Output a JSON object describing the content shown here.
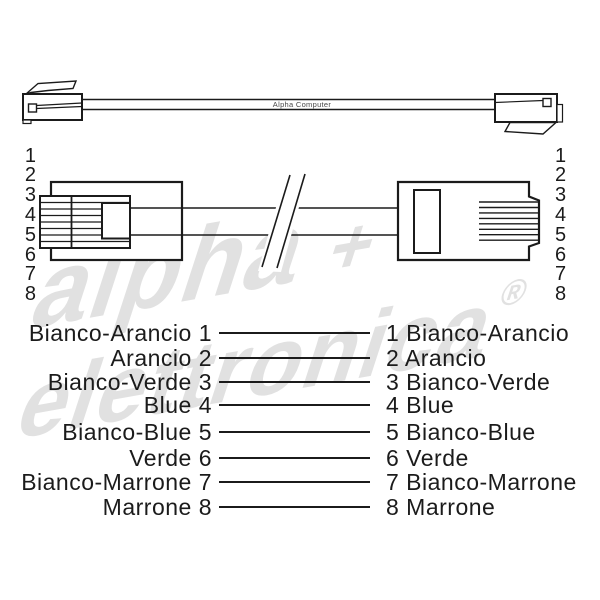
{
  "watermark": {
    "word1": "alpha",
    "plus": "+",
    "word2": "elettronica",
    "registered": "®",
    "color": "#e1e1e1"
  },
  "cable": {
    "brand_label": "Alpha Computer"
  },
  "pin_numbers": [
    "1",
    "2",
    "3",
    "4",
    "5",
    "6",
    "7",
    "8"
  ],
  "wiring_rows": [
    {
      "pin": "1",
      "color_name": "Bianco-Arancio",
      "left": "Bianco-Arancio 1",
      "right": "1 Bianco-Arancio"
    },
    {
      "pin": "2",
      "color_name": "Arancio",
      "left": "Arancio 2",
      "right": "2 Arancio"
    },
    {
      "pin": "3",
      "color_name": "Bianco-Verde",
      "left": "Bianco-Verde 3",
      "right": "3 Bianco-Verde"
    },
    {
      "pin": "4",
      "color_name": "Blue",
      "left": "Blue 4",
      "right": "4 Blue"
    },
    {
      "pin": "5",
      "color_name": "Bianco-Blue",
      "left": "Bianco-Blue 5",
      "right": "5 Bianco-Blue"
    },
    {
      "pin": "6",
      "color_name": "Verde",
      "left": "Verde 6",
      "right": "6 Verde"
    },
    {
      "pin": "7",
      "color_name": "Bianco-Marrone",
      "left": "Bianco-Marrone 7",
      "right": "7 Bianco-Marrone"
    },
    {
      "pin": "8",
      "color_name": "Marrone",
      "left": "Marrone 8",
      "right": "8 Marrone"
    }
  ],
  "colors": {
    "ink": "#1b1b1b",
    "watermark": "#e1e1e1",
    "cable_label_text": "#4a4a4a"
  }
}
